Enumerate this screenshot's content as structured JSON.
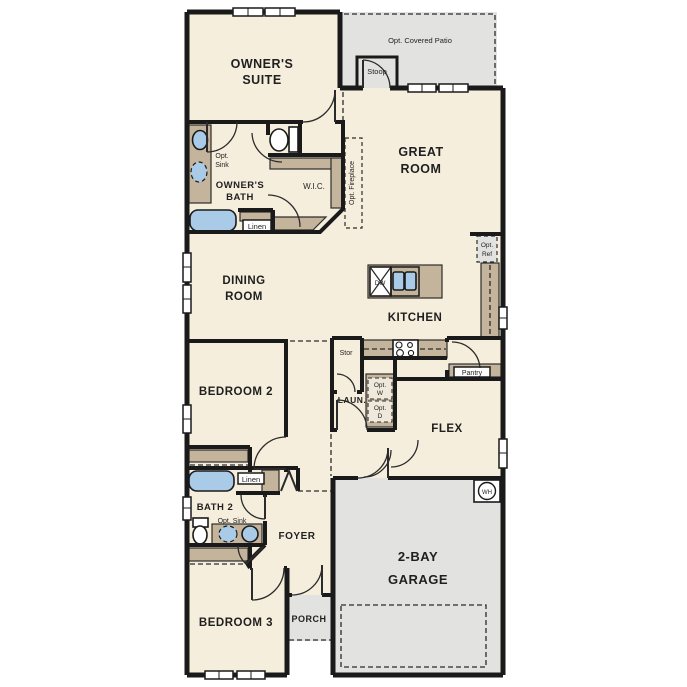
{
  "colors": {
    "floor": "#f6eedd",
    "outdoor": "#e2e2e0",
    "cabinet": "#c4b49c",
    "fixture": "#a9cbe8",
    "wall": "#1a1a1a"
  },
  "rooms": {
    "owners_suite": [
      "OWNER'S",
      "SUITE"
    ],
    "owners_bath": [
      "OWNER'S",
      "BATH"
    ],
    "great_room": [
      "GREAT",
      "ROOM"
    ],
    "dining_room": [
      "DINING",
      "ROOM"
    ],
    "kitchen": "KITCHEN",
    "bedroom_2": "BEDROOM 2",
    "bedroom_3": "BEDROOM 3",
    "flex": "FLEX",
    "foyer": "FOYER",
    "porch": "PORCH",
    "garage": [
      "2-BAY",
      "GARAGE"
    ],
    "laundry": "LAUN.",
    "wic": "W.I.C.",
    "bath_2": "BATH 2"
  },
  "features": {
    "opt_covered_patio": "Opt. Covered Patio",
    "stoop": "Stoop",
    "opt_fireplace": "Opt. Fireplace",
    "opt_sink_owners": [
      "Opt.",
      "Sink"
    ],
    "opt_sink_bath2": "Opt. Sink",
    "linen_owners": "Linen",
    "linen_hall": "Linen",
    "opt_ref": [
      "Opt.",
      "Ref"
    ],
    "dishwasher": "DW",
    "storage": "Stor",
    "pantry": "Pantry",
    "opt_washer": [
      "Opt.",
      "W"
    ],
    "opt_dryer": [
      "Opt.",
      "D"
    ],
    "water_heater": "WH"
  }
}
